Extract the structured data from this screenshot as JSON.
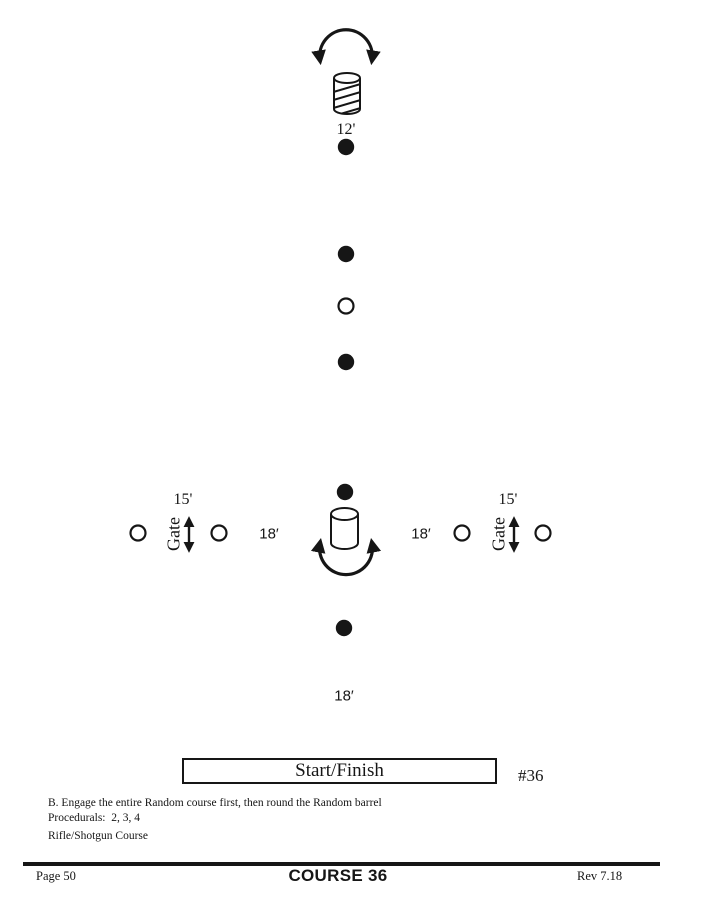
{
  "diagram": {
    "top_barrel_distance": "12'",
    "left_gate": {
      "label": "Gate",
      "width": "15'"
    },
    "right_gate": {
      "label": "Gate",
      "width": "15'"
    },
    "left_spacing": "18′",
    "right_spacing": "18′",
    "bottom_spacing": "18′",
    "start_finish_label": "Start/Finish",
    "course_number": "#36"
  },
  "notes": {
    "instruction": "B. Engage the entire Random course first, then round the Random barrel",
    "procedurals": "Procedurals:  2, 3, 4",
    "course_type": "Rifle/Shotgun Course"
  },
  "footer": {
    "page_number": "Page 50",
    "course_title": "COURSE 36",
    "revision": "Rev 7.18"
  },
  "colors": {
    "ink": "#161616",
    "background": "#ffffff"
  }
}
